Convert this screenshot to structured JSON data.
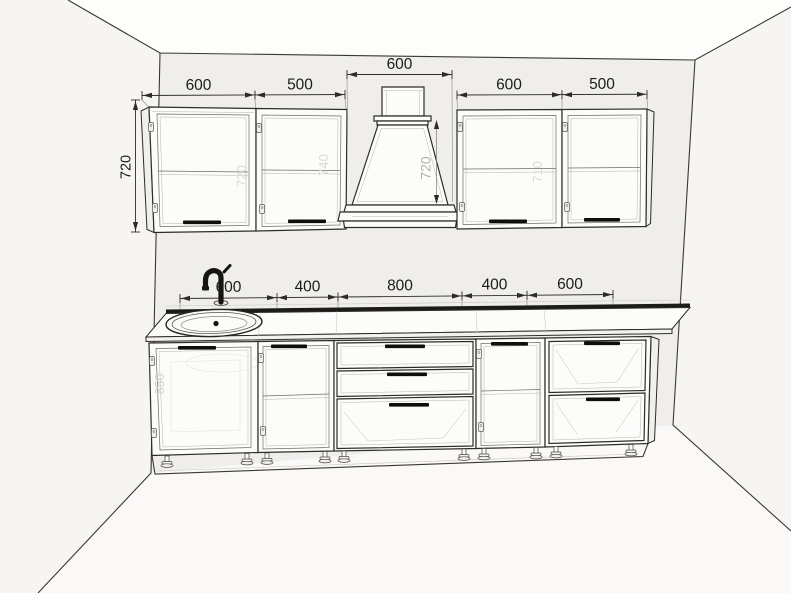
{
  "drawing_type": "kitchen elevation line drawing",
  "colors": {
    "background": "#fbfbfa",
    "back_wall": "#efeeec",
    "side_wall": "#f6f5f3",
    "ceiling": "#fdfdfc",
    "floor": "#faf9f8",
    "line": "#2e2c29",
    "handle": "#0f0e0c",
    "dim_text": "#1c1b19",
    "faint_text": "#dcdad6"
  },
  "dims": {
    "upper_left": [
      "600",
      "500"
    ],
    "upper_left_height": "720",
    "hood_width": "600",
    "hood_height": "720",
    "upper_right": [
      "600",
      "500"
    ],
    "base": [
      "600",
      "400",
      "800",
      "400",
      "600"
    ],
    "base_height": "850",
    "faint_inner": [
      "720",
      "740",
      "710"
    ]
  }
}
